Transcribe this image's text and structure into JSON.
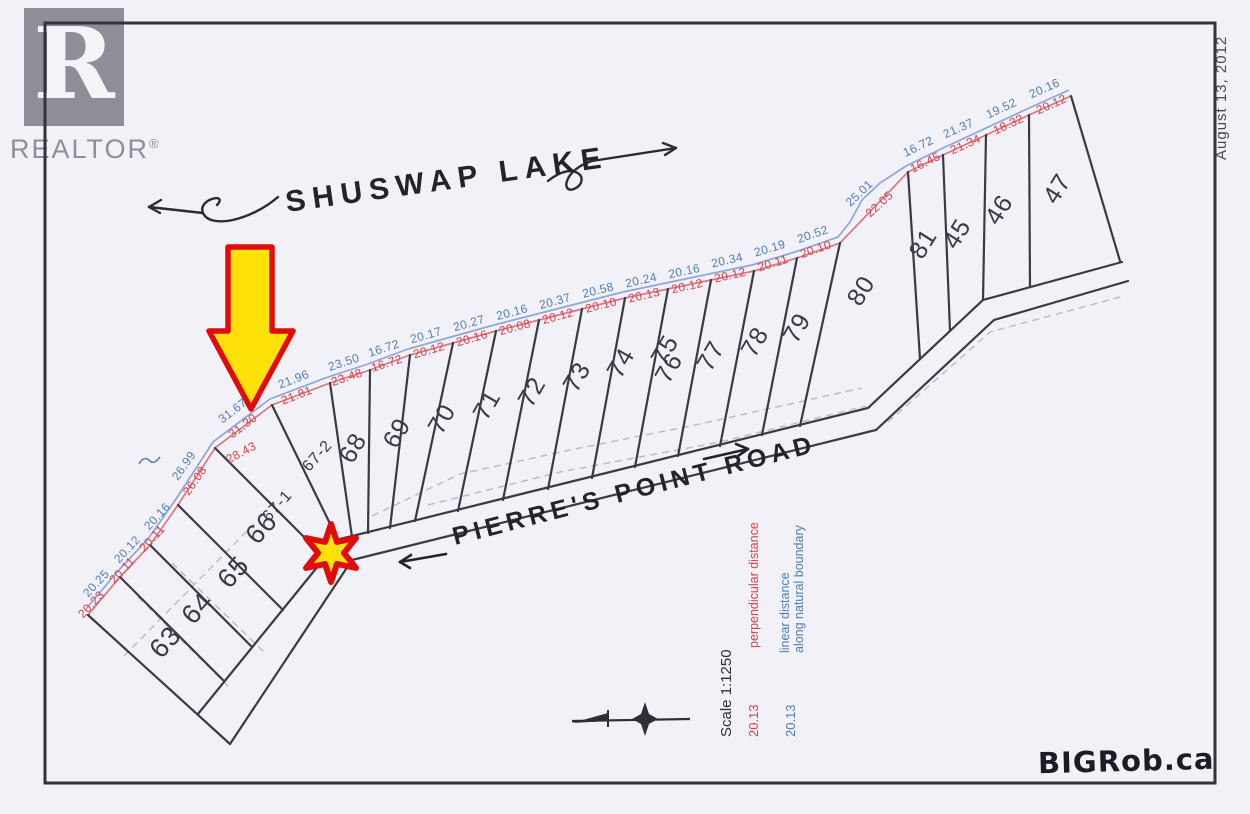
{
  "branding": {
    "logo_letter": "R",
    "logo_name": "REALTOR",
    "registered_mark": "®",
    "scan_date": "August 13, 2012",
    "watermark": "BIGRob.ca"
  },
  "annotations": {
    "lake": "SHUSWAP LAKE",
    "road": "PIERRE'S POINT ROAD"
  },
  "legend": {
    "scale": "Scale 1:1250",
    "red_sample": "20.13",
    "red_meaning": "perpendicular distance",
    "blue_sample": "20.13",
    "blue_meaning_line1": "linear distance",
    "blue_meaning_line2": "along natural boundary"
  },
  "colors": {
    "paper": "#f2f1f7",
    "ink": "#3a3a45",
    "measure_red": "#d9404a",
    "measure_blue": "#4d7dbd",
    "highlight_yellow": "#ffe10a",
    "highlight_red": "#e00b0b",
    "logo_gray": "#8e8e99"
  },
  "lots": [
    {
      "id": "63",
      "x": 172,
      "y": 648,
      "r": -48,
      "s": 27
    },
    {
      "id": "64",
      "x": 204,
      "y": 614,
      "r": -48,
      "s": 27
    },
    {
      "id": "65",
      "x": 240,
      "y": 578,
      "r": -48,
      "s": 27
    },
    {
      "id": "66",
      "x": 268,
      "y": 534,
      "r": -48,
      "s": 27
    },
    {
      "id": "67-1",
      "x": 281,
      "y": 509,
      "r": -48,
      "s": 16
    },
    {
      "id": "67-2",
      "x": 321,
      "y": 459,
      "r": -48,
      "s": 16
    },
    {
      "id": "68",
      "x": 360,
      "y": 452,
      "r": -60,
      "s": 25
    },
    {
      "id": "69",
      "x": 404,
      "y": 437,
      "r": -60,
      "s": 25
    },
    {
      "id": "70",
      "x": 449,
      "y": 423,
      "r": -60,
      "s": 25
    },
    {
      "id": "71",
      "x": 494,
      "y": 409,
      "r": -60,
      "s": 25
    },
    {
      "id": "72",
      "x": 539,
      "y": 396,
      "r": -60,
      "s": 25
    },
    {
      "id": "73",
      "x": 584,
      "y": 381,
      "r": -60,
      "s": 25
    },
    {
      "id": "74",
      "x": 628,
      "y": 367,
      "r": -60,
      "s": 25
    },
    {
      "id": "75",
      "x": 672,
      "y": 354,
      "r": -60,
      "s": 25
    },
    {
      "id": "76",
      "x": 676,
      "y": 372,
      "r": -60,
      "s": 25
    },
    {
      "id": "77",
      "x": 718,
      "y": 360,
      "r": -60,
      "s": 25
    },
    {
      "id": "78",
      "x": 762,
      "y": 346,
      "r": -60,
      "s": 25
    },
    {
      "id": "79",
      "x": 804,
      "y": 332,
      "r": -60,
      "s": 25
    },
    {
      "id": "80",
      "x": 868,
      "y": 295,
      "r": -58,
      "s": 25
    },
    {
      "id": "81",
      "x": 930,
      "y": 248,
      "r": -58,
      "s": 25
    },
    {
      "id": "45",
      "x": 964,
      "y": 238,
      "r": -58,
      "s": 25
    },
    {
      "id": "46",
      "x": 1006,
      "y": 214,
      "r": -58,
      "s": 25
    },
    {
      "id": "47",
      "x": 1064,
      "y": 193,
      "r": -58,
      "s": 25
    }
  ],
  "measurements": {
    "blue": [
      {
        "v": "20.25",
        "x": 99,
        "y": 586,
        "r": -47
      },
      {
        "v": "20.12",
        "x": 130,
        "y": 552,
        "r": -47
      },
      {
        "v": "20.16",
        "x": 160,
        "y": 519,
        "r": -47
      },
      {
        "v": "26.99",
        "x": 187,
        "y": 468,
        "r": -55
      },
      {
        "v": "31.67",
        "x": 235,
        "y": 414,
        "r": -37
      },
      {
        "v": "21.96",
        "x": 295,
        "y": 383,
        "r": -21
      },
      {
        "v": "23.50",
        "x": 345,
        "y": 366,
        "r": -18
      },
      {
        "v": "16.72",
        "x": 385,
        "y": 352,
        "r": -18
      },
      {
        "v": "20.17",
        "x": 427,
        "y": 339,
        "r": -16
      },
      {
        "v": "20.27",
        "x": 470,
        "y": 327,
        "r": -16
      },
      {
        "v": "20.16",
        "x": 513,
        "y": 316,
        "r": -15
      },
      {
        "v": "20.37",
        "x": 556,
        "y": 305,
        "r": -15
      },
      {
        "v": "20.58",
        "x": 599,
        "y": 294,
        "r": -14
      },
      {
        "v": "20.24",
        "x": 642,
        "y": 284,
        "r": -13
      },
      {
        "v": "20.16",
        "x": 685,
        "y": 275,
        "r": -12
      },
      {
        "v": "20.34",
        "x": 728,
        "y": 264,
        "r": -13
      },
      {
        "v": "20.19",
        "x": 771,
        "y": 252,
        "r": -17
      },
      {
        "v": "20.52",
        "x": 814,
        "y": 238,
        "r": -19
      },
      {
        "v": "25.01",
        "x": 862,
        "y": 196,
        "r": -44
      },
      {
        "v": "16.72",
        "x": 920,
        "y": 150,
        "r": -26
      },
      {
        "v": "21.37",
        "x": 960,
        "y": 132,
        "r": -24
      },
      {
        "v": "19.52",
        "x": 1003,
        "y": 112,
        "r": -25
      },
      {
        "v": "20.16",
        "x": 1046,
        "y": 92,
        "r": -24
      }
    ],
    "red": [
      {
        "v": "20.23",
        "x": 94,
        "y": 607,
        "r": -47
      },
      {
        "v": "20.11",
        "x": 125,
        "y": 573,
        "r": -47
      },
      {
        "v": "20.11",
        "x": 155,
        "y": 541,
        "r": -47
      },
      {
        "v": "26.08",
        "x": 198,
        "y": 483,
        "r": -55
      },
      {
        "v": "31.30",
        "x": 245,
        "y": 429,
        "r": -37
      },
      {
        "v": "28.43",
        "x": 243,
        "y": 456,
        "r": -28
      },
      {
        "v": "21.81",
        "x": 298,
        "y": 399,
        "r": -21
      },
      {
        "v": "23.48",
        "x": 348,
        "y": 381,
        "r": -18
      },
      {
        "v": "16.72",
        "x": 388,
        "y": 367,
        "r": -18
      },
      {
        "v": "20.12",
        "x": 430,
        "y": 354,
        "r": -16
      },
      {
        "v": "20.16",
        "x": 473,
        "y": 342,
        "r": -16
      },
      {
        "v": "20.08",
        "x": 516,
        "y": 331,
        "r": -15
      },
      {
        "v": "20.12",
        "x": 559,
        "y": 320,
        "r": -15
      },
      {
        "v": "20.10",
        "x": 602,
        "y": 309,
        "r": -14
      },
      {
        "v": "20.13",
        "x": 645,
        "y": 299,
        "r": -13
      },
      {
        "v": "20.12",
        "x": 688,
        "y": 290,
        "r": -12
      },
      {
        "v": "20.12",
        "x": 731,
        "y": 279,
        "r": -13
      },
      {
        "v": "20.11",
        "x": 774,
        "y": 267,
        "r": -17
      },
      {
        "v": "20.10",
        "x": 817,
        "y": 253,
        "r": -19
      },
      {
        "v": "22.05",
        "x": 882,
        "y": 207,
        "r": -42
      },
      {
        "v": "16.45",
        "x": 927,
        "y": 166,
        "r": -26
      },
      {
        "v": "21.34",
        "x": 967,
        "y": 148,
        "r": -24
      },
      {
        "v": "18.32",
        "x": 1010,
        "y": 128,
        "r": -25
      },
      {
        "v": "20.12",
        "x": 1053,
        "y": 108,
        "r": -24
      }
    ]
  }
}
